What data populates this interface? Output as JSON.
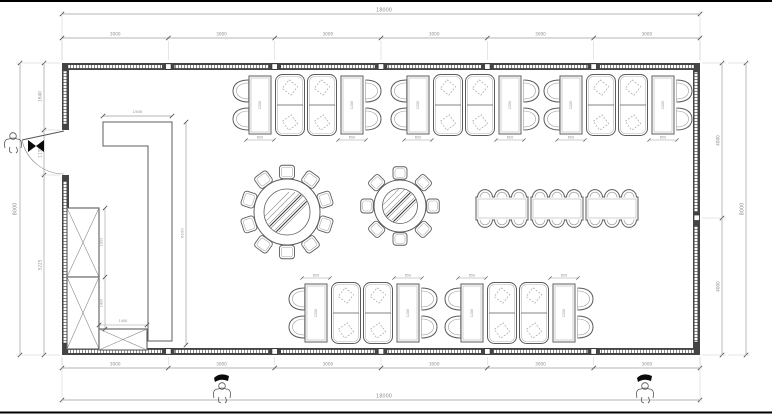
{
  "dimensions": {
    "top": {
      "overall": "18000",
      "bays": [
        "3000",
        "3000",
        "3000",
        "3000",
        "3000",
        "3000"
      ]
    },
    "bottom": {
      "overall": "18000",
      "bays": [
        "3000",
        "3000",
        "3000",
        "3000",
        "3000",
        "3000"
      ]
    },
    "left": {
      "overall": "8000",
      "segments": [
        "1640",
        "1135",
        "5225"
      ]
    },
    "right": {
      "overall": "8000",
      "segments": [
        "4000",
        "4000"
      ]
    },
    "interior": {
      "counter_width": "1500",
      "counter_return": "6100",
      "cabinet_upper": "1900",
      "cabinet_lower": "1400",
      "cabinet_bottom_width": "1400",
      "table_width": "650",
      "table_length": "1200"
    }
  },
  "furniture": {
    "top_row_groups": 3,
    "bottom_row_groups": 2,
    "group_layout": "2-seat table with tub chairs + two 4-seat booths + 2-seat table with tub chairs",
    "round_table_large_seats": 10,
    "round_table_small_seats": 8,
    "banquet_tables": 3,
    "banquet_total_seats": 18,
    "storage_cabinets": 3,
    "scale_figures": 3,
    "entrance": "left wall door"
  },
  "colors": {
    "wall": "#454545",
    "furniture_line": "#5c5c5c",
    "dimension_line": "#9e9e9e",
    "text": "#8a8f94",
    "marker_black": "#0a0a0a"
  }
}
